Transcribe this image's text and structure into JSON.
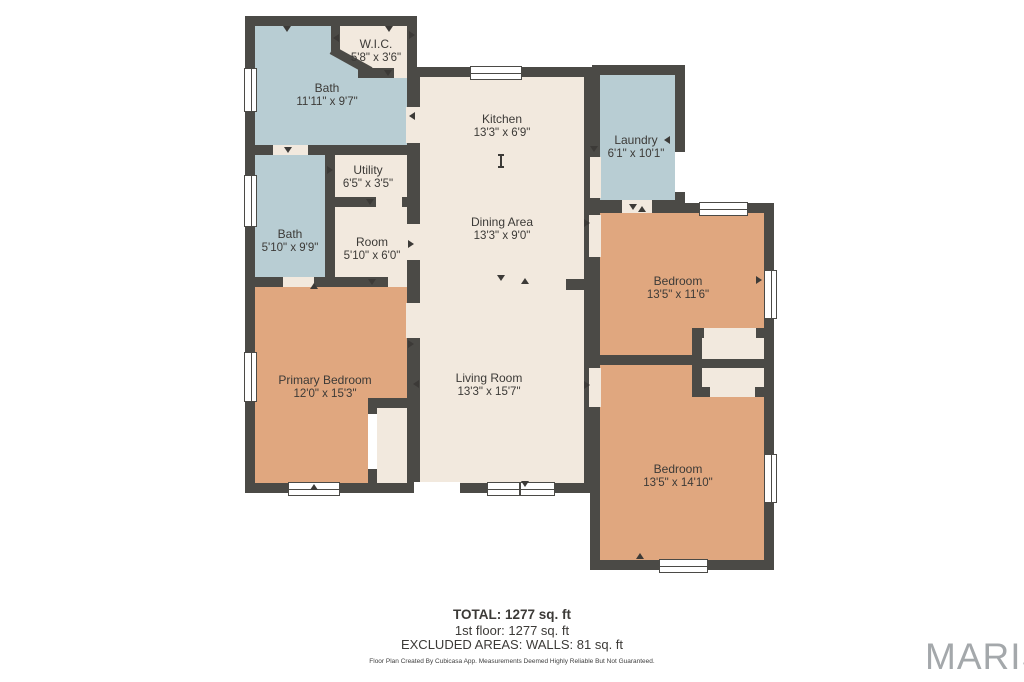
{
  "palette": {
    "bg": "#ffffff",
    "wall": "#4b4a46",
    "wet": "#b8cdd3",
    "dry": "#f2e9de",
    "bed": "#e0a77f",
    "ink": "#3c3a37",
    "logo": "#a4a8ab"
  },
  "plan": {
    "rooms": [
      {
        "id": "wic",
        "name": "W.I.C.",
        "dims": "5'8\" x 3'6\""
      },
      {
        "id": "bath1",
        "name": "Bath",
        "dims": "11'11\" x 9'7\""
      },
      {
        "id": "kitchen",
        "name": "Kitchen",
        "dims": "13'3\" x 6'9\""
      },
      {
        "id": "laundry",
        "name": "Laundry",
        "dims": "6'1\" x 10'1\""
      },
      {
        "id": "utility",
        "name": "Utility",
        "dims": "6'5\" x 3'5\""
      },
      {
        "id": "bath2",
        "name": "Bath",
        "dims": "5'10\" x 9'9\""
      },
      {
        "id": "room",
        "name": "Room",
        "dims": "5'10\" x 6'0\""
      },
      {
        "id": "dining",
        "name": "Dining Area",
        "dims": "13'3\" x 9'0\""
      },
      {
        "id": "bedroom1",
        "name": "Bedroom",
        "dims": "13'5\" x 11'6\""
      },
      {
        "id": "primary",
        "name": "Primary Bedroom",
        "dims": "12'0\" x 15'3\""
      },
      {
        "id": "living",
        "name": "Living Room",
        "dims": "13'3\" x 15'7\""
      },
      {
        "id": "bedroom2",
        "name": "Bedroom",
        "dims": "13'5\" x 14'10\""
      }
    ],
    "icons": {
      "door_marker": "small black triangle at door openings",
      "window": "white double-line window symbol in wall"
    }
  },
  "footer": {
    "total": "TOTAL: 1277 sq. ft",
    "floor1": "1st floor: 1277 sq. ft",
    "excluded": "EXCLUDED AREAS: WALLS: 81 sq. ft",
    "disclaimer": "Floor Plan Created By Cubicasa App. Measurements Deemed Highly Reliable But Not Guaranteed."
  },
  "branding": {
    "logo": "MARIS"
  }
}
